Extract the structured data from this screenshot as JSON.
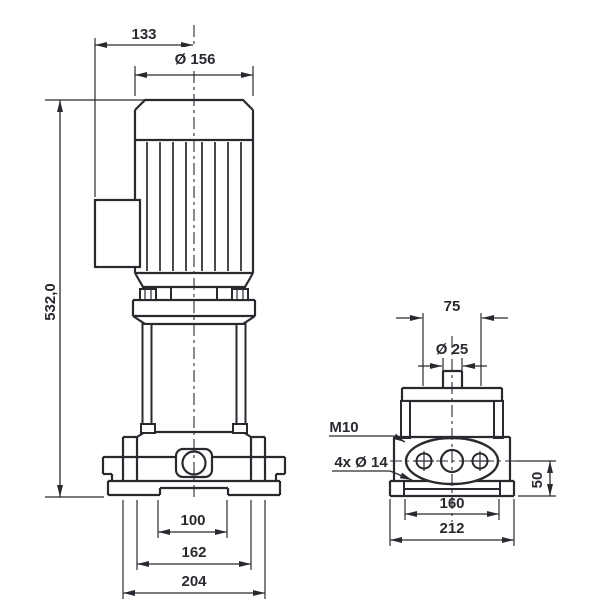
{
  "colors": {
    "line": "#2b2930",
    "background": "#ffffff"
  },
  "dims": {
    "top_width": "133",
    "motor_diameter": "Ø 156",
    "overall_height": "532,0",
    "bolt_spacing_front": "100",
    "foot_spacing_front": "162",
    "base_width_front": "204",
    "port_offset": "75",
    "port_diameter": "Ø 25",
    "stud_thread": "M10",
    "mounting_holes": "4x Ø 14",
    "base_height": "50",
    "bolt_spacing_side": "160",
    "base_width_side": "212"
  }
}
